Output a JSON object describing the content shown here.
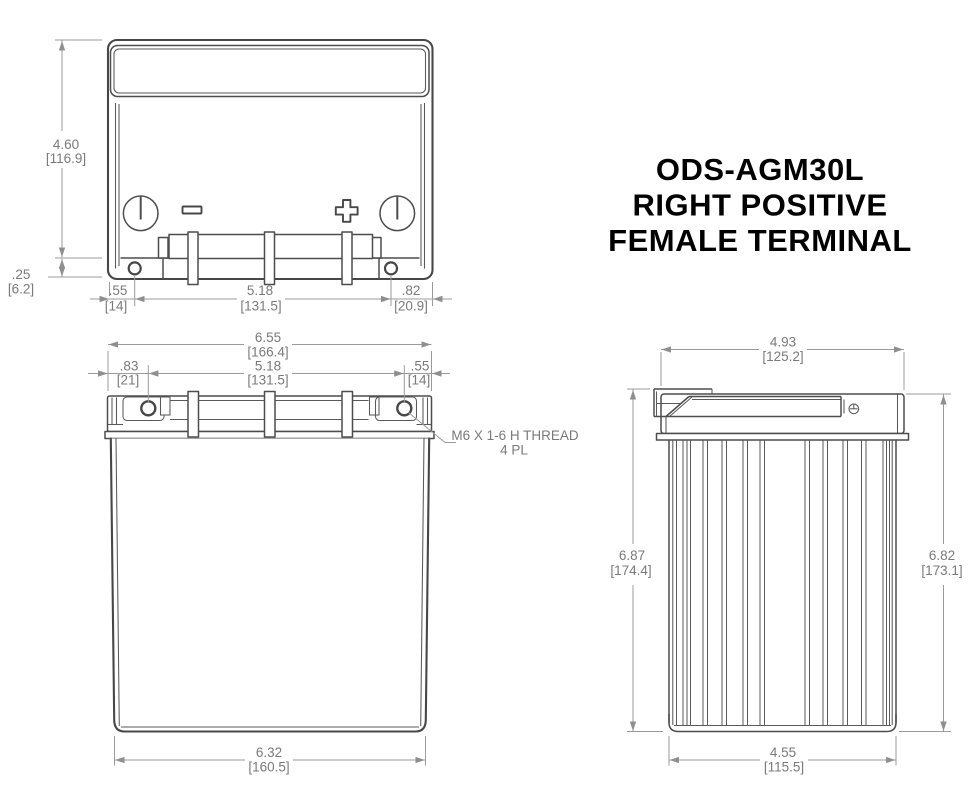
{
  "title": {
    "line1": "ODS-AGM30L",
    "line2": "RIGHT POSITIVE",
    "line3": "FEMALE TERMINAL"
  },
  "top_view": {
    "symbols": {
      "negative": "-",
      "positive": "+"
    },
    "dims": {
      "height": {
        "in": "4.60",
        "mm": "[116.9]"
      },
      "flange": {
        "in": ".25",
        "mm": "[6.2]"
      },
      "hole_left": {
        "in": ".55",
        "mm": "[14]"
      },
      "hole_spacing": {
        "in": "5.18",
        "mm": "[131.5]"
      },
      "hole_right": {
        "in": ".82",
        "mm": "[20.9]"
      }
    }
  },
  "front_view": {
    "dims": {
      "width": {
        "in": "6.55",
        "mm": "[166.4]"
      },
      "terminal_left": {
        "in": ".83",
        "mm": "[21]"
      },
      "terminal_spacing": {
        "in": "5.18",
        "mm": "[131.5]"
      },
      "terminal_right": {
        "in": ".55",
        "mm": "[14]"
      },
      "base": {
        "in": "6.32",
        "mm": "[160.5]"
      }
    },
    "thread_note": {
      "line1": "M6 X 1-6 H THREAD",
      "line2": "4 PL"
    }
  },
  "side_view": {
    "dims": {
      "width": {
        "in": "4.93",
        "mm": "[125.2]"
      },
      "height_left": {
        "in": "6.87",
        "mm": "[174.4]"
      },
      "height_right": {
        "in": "6.82",
        "mm": "[173.1]"
      },
      "base": {
        "in": "4.55",
        "mm": "[115.5]"
      }
    }
  },
  "colors": {
    "background": "#ffffff",
    "outline": "#474747",
    "dimension": "#9b9b9b",
    "dimension_text": "#7a7a7a",
    "title_text": "#000000"
  }
}
